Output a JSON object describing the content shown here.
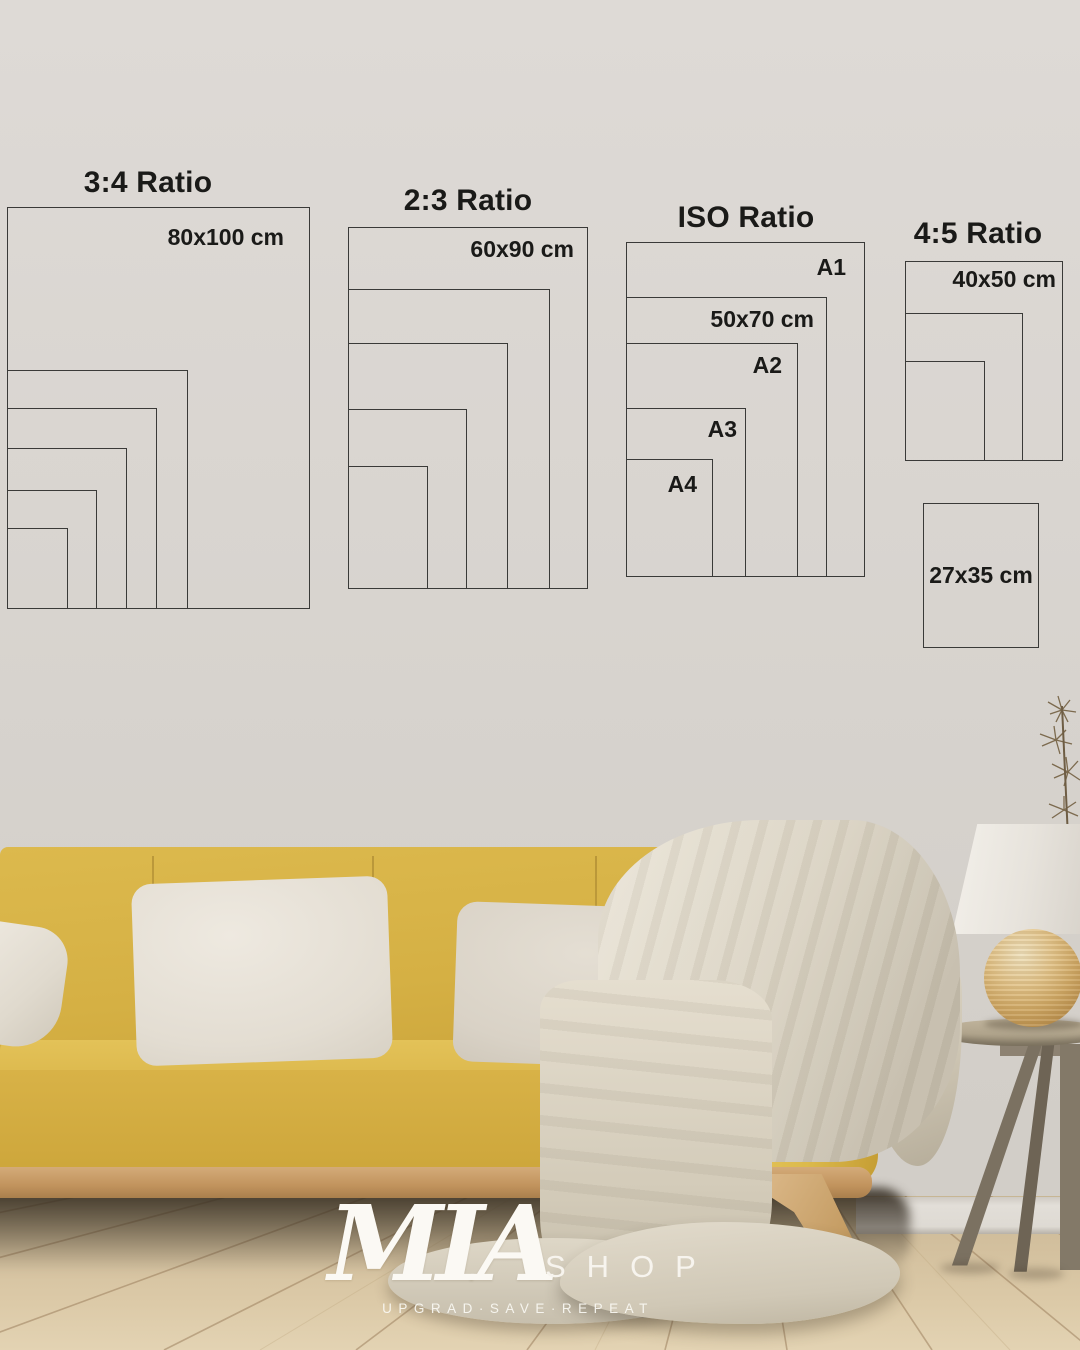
{
  "size_chart": {
    "line_color": "#3a3a38",
    "text_color": "#1a1a18",
    "groups": [
      {
        "id": "ratio-3-4",
        "title": "3:4 Ratio",
        "title_x": 148,
        "title_y": 183,
        "rects": [
          {
            "x": 7,
            "y": 207,
            "w": 303,
            "h": 402,
            "label": "80x100 cm",
            "pos": "tr",
            "dx": 25,
            "dy": 18
          },
          {
            "x": 7,
            "y": 370,
            "w": 181,
            "h": 239
          },
          {
            "x": 7,
            "y": 408,
            "w": 150,
            "h": 201
          },
          {
            "x": 7,
            "y": 448,
            "w": 120,
            "h": 161
          },
          {
            "x": 7,
            "y": 490,
            "w": 90,
            "h": 119
          },
          {
            "x": 7,
            "y": 528,
            "w": 61,
            "h": 81
          }
        ]
      },
      {
        "id": "ratio-2-3",
        "title": "2:3 Ratio",
        "title_x": 468,
        "title_y": 201,
        "rects": [
          {
            "x": 348,
            "y": 227,
            "w": 240,
            "h": 362,
            "label": "60x90 cm",
            "pos": "tr",
            "dx": 13,
            "dy": 10
          },
          {
            "x": 348,
            "y": 289,
            "w": 202,
            "h": 300
          },
          {
            "x": 348,
            "y": 343,
            "w": 160,
            "h": 246
          },
          {
            "x": 348,
            "y": 409,
            "w": 119,
            "h": 180
          },
          {
            "x": 348,
            "y": 466,
            "w": 80,
            "h": 123
          }
        ]
      },
      {
        "id": "ratio-iso",
        "title": "ISO Ratio",
        "title_x": 746,
        "title_y": 218,
        "rects": [
          {
            "x": 626,
            "y": 242,
            "w": 239,
            "h": 335,
            "label": "A1",
            "pos": "tr",
            "dx": 18,
            "dy": 13
          },
          {
            "x": 626,
            "y": 297,
            "w": 201,
            "h": 280,
            "label": "50x70 cm",
            "pos": "tr",
            "dx": 12,
            "dy": 10
          },
          {
            "x": 626,
            "y": 343,
            "w": 172,
            "h": 234,
            "label": "A2",
            "pos": "tr",
            "dx": 15,
            "dy": 10
          },
          {
            "x": 626,
            "y": 408,
            "w": 120,
            "h": 169,
            "label": "A3",
            "pos": "tr",
            "dx": 8,
            "dy": 9
          },
          {
            "x": 626,
            "y": 459,
            "w": 87,
            "h": 118,
            "label": "A4",
            "pos": "tr",
            "dx": 15,
            "dy": 13
          }
        ]
      },
      {
        "id": "ratio-4-5",
        "title": "4:5 Ratio",
        "title_x": 978,
        "title_y": 234,
        "rects": [
          {
            "x": 905,
            "y": 261,
            "w": 158,
            "h": 200,
            "label": "40x50 cm",
            "pos": "tr",
            "dx": 6,
            "dy": 6
          },
          {
            "x": 905,
            "y": 313,
            "w": 118,
            "h": 148
          },
          {
            "x": 905,
            "y": 361,
            "w": 80,
            "h": 100
          }
        ]
      },
      {
        "id": "size-27x35",
        "title": "",
        "rects": [
          {
            "x": 923,
            "y": 503,
            "w": 116,
            "h": 145,
            "label": "27x35 cm",
            "pos": "c"
          }
        ]
      }
    ]
  },
  "brand": {
    "name": "MIA",
    "suffix": "SHOP",
    "tagline": "UPGRAD·SAVE·REPEAT"
  },
  "palette": {
    "wall": "#d8d4cf",
    "sofa_yellow": "#d5b044",
    "pillow_cream": "#e8e3da",
    "blanket_cream": "#d8d1c1",
    "floor_wood": "#d6c3a1",
    "rail_wood": "#c1935d",
    "diagram_line": "#3a3a38",
    "diagram_text": "#1a1a18",
    "logo_white": "#fbf9f4"
  }
}
